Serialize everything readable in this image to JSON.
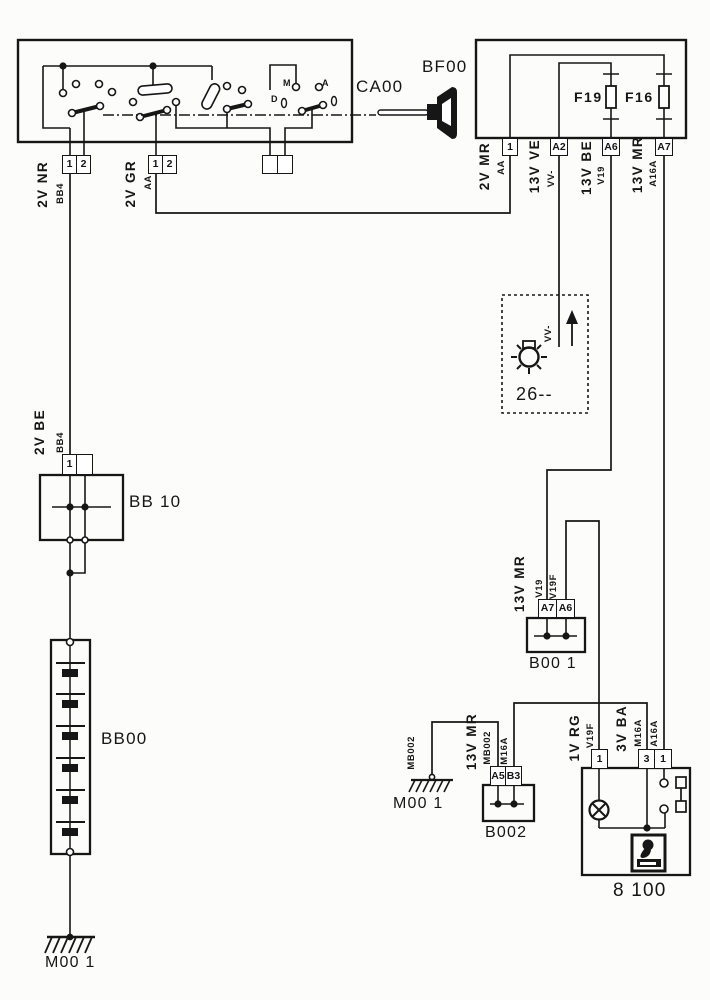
{
  "colors": {
    "ink": "#161616",
    "paper": "#fcfcfa"
  },
  "components": {
    "ca00": {
      "label": "CA00"
    },
    "bf00_key": {
      "label": "BF00"
    },
    "fuse_f19": {
      "label": "F19"
    },
    "fuse_f16": {
      "label": "F16"
    },
    "bb10": {
      "label": "BB 10"
    },
    "bb00": {
      "label": "BB00"
    },
    "b001": {
      "label": "B00 1"
    },
    "b002": {
      "label": "B002"
    },
    "unit_8100": {
      "label": "8 100"
    },
    "ground_left": {
      "label": "M00 1"
    },
    "ground_right": {
      "label": "M00 1"
    },
    "box26": {
      "label": "26--"
    }
  },
  "pins": {
    "ca00_g1": [
      "1",
      "2"
    ],
    "ca00_g2": [
      "1",
      "2"
    ],
    "ca00_g3": [
      "",
      ""
    ],
    "bf00": [
      "1",
      "A2",
      "A6",
      "A7"
    ],
    "bb10": [
      "1",
      ""
    ],
    "b001": [
      "A7",
      "A6"
    ],
    "b002": [
      "A5",
      "B3"
    ],
    "unit_8100": [
      "1",
      "3",
      "1"
    ]
  },
  "wires": {
    "nr": {
      "gauge": "2V NR",
      "code": "BB4"
    },
    "gr": {
      "gauge": "2V GR",
      "code": "AA"
    },
    "mr": {
      "gauge": "2V MR",
      "code": "AA"
    },
    "ve": {
      "gauge": "13V VE",
      "code": "VV-"
    },
    "be": {
      "gauge": "13V BE",
      "code": "V19"
    },
    "mr13": {
      "gauge": "13V MR",
      "code": "A16A"
    },
    "be2": {
      "gauge": "2V BE",
      "code": "BB4"
    },
    "b001": {
      "gauge": "13V MR",
      "code_a7": "V19",
      "code_a6": "V19F"
    },
    "b002": {
      "gauge": "13V MR",
      "code_a5": "MB002",
      "code_b3": "M16A"
    },
    "ground_link": {
      "code": "MB002"
    },
    "rg": {
      "gauge": "1V RG",
      "code": "V19F"
    },
    "ba": {
      "gauge": "3V BA",
      "code_3": "M16A",
      "code_1": "A16A"
    },
    "box26": {
      "code": "VV-"
    }
  },
  "switch_positions": {
    "m": "M",
    "a": "A",
    "d": "D"
  }
}
